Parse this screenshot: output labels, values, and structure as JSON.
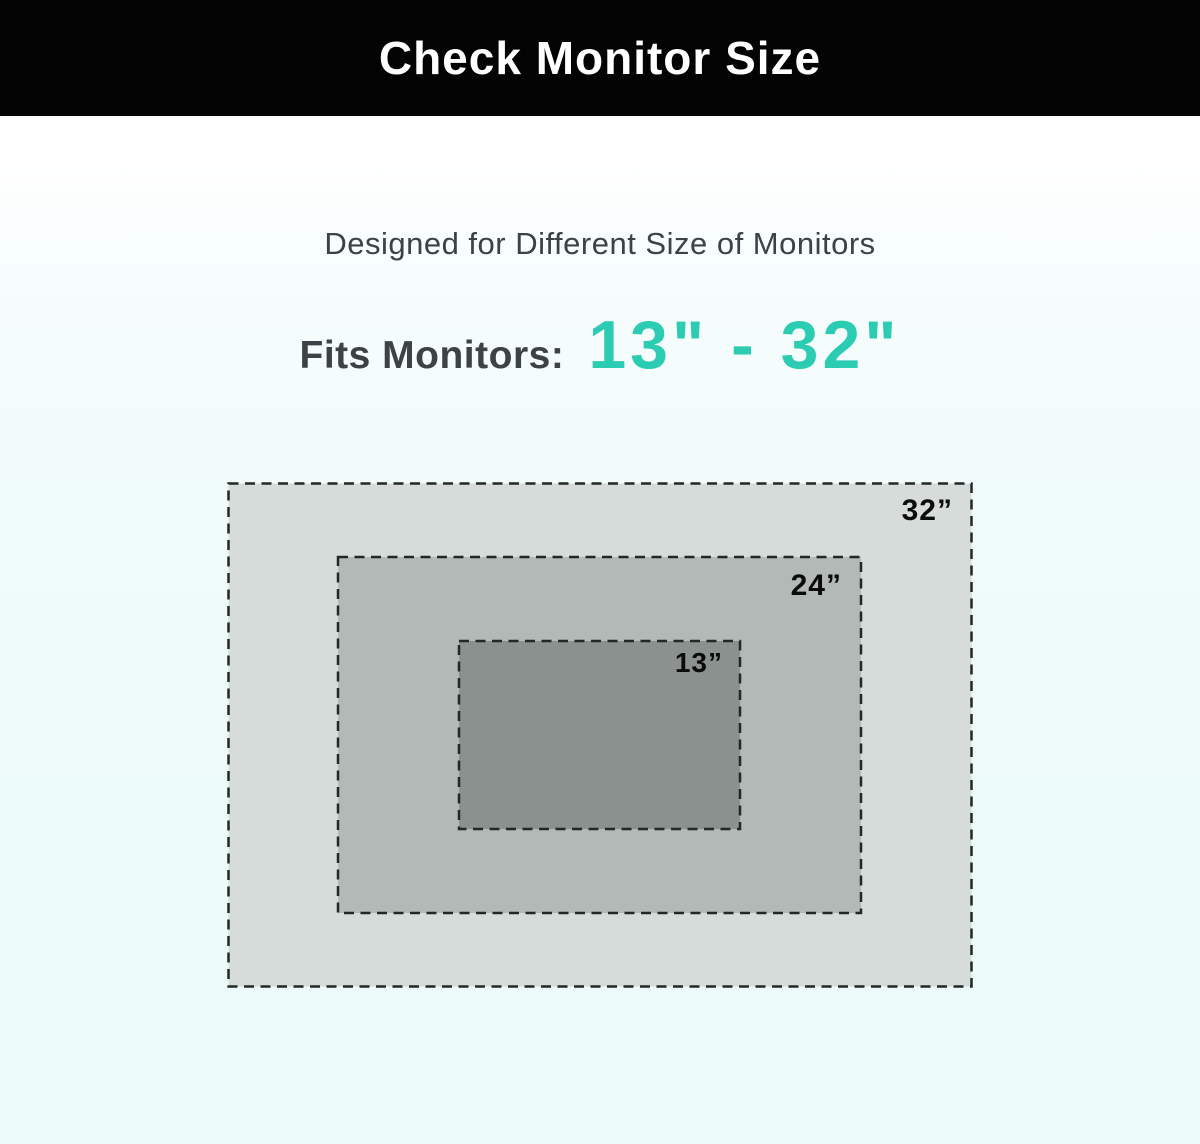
{
  "header": {
    "title": "Check Monitor Size"
  },
  "subtitle": "Designed for Different Size of Monitors",
  "fits": {
    "label": "Fits Monitors:",
    "range": "13\" - 32\""
  },
  "diagram": {
    "monitors": [
      {
        "size_label": "32”",
        "fill": "#d6dcd9"
      },
      {
        "size_label": "24”",
        "fill": "#b2b9b6"
      },
      {
        "size_label": "13”",
        "fill": "#8b918e"
      }
    ]
  },
  "colors": {
    "accent_teal": "#2bccb1",
    "header_bg": "#030303",
    "title_text": "#ffffff",
    "body_text": "#3c4245",
    "size_label_text": "#0b0b0b",
    "dash_border": "#232825",
    "page_bg_bottom": "#ecfafa"
  }
}
